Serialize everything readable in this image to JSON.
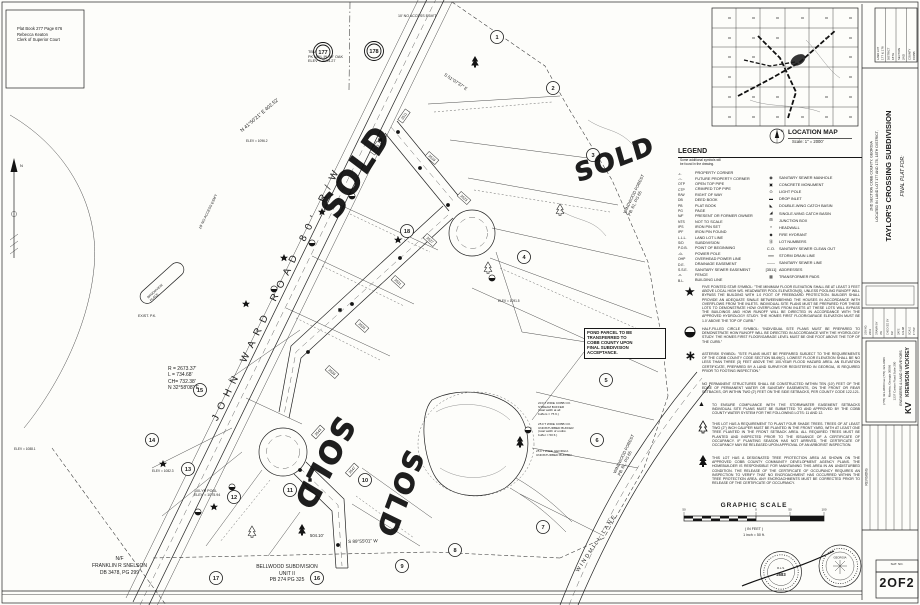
{
  "sheet": {
    "stamp": {
      "line1": "Plat Book 277 Page 676",
      "line2": "Rebecca Keaton",
      "line3": "Clerk of Superior Court"
    },
    "sheet_no": "2OF2",
    "sheet_no_strip": "SHT. NO."
  },
  "title_block": {
    "corner_table": {
      "labels": [
        "LAND LOT",
        "DISTRICT",
        "SECTION",
        "COUNTY"
      ],
      "values": [
        "177 & 178",
        "18TH",
        "2ND",
        "COBB"
      ]
    },
    "final_plat_for": "FINAL PLAT FOR:",
    "title": "TAYLOR'S CROSSING SUBDIVISION",
    "location_line1": "LOCATED IN LAND LOT 177 AND 178, 18TH DISTRICT,",
    "location_line2": "2ND SECTION COBB COUNTY, GEORGIA",
    "info": {
      "labels": [
        "JOB NO.",
        "DRAWN BY",
        "CHECKED BY",
        "DATE",
        "SCALE"
      ],
      "values": [
        "2411",
        "JW",
        "KV",
        "6-9-98",
        "1\"=50'"
      ]
    },
    "firm": {
      "logo": "KV",
      "name": "KREWSON  VICKREY",
      "type": "ENGINEERS & LAND SURVEYORS",
      "addr1": "1237 Canton Road  Suite 200",
      "addr2": "Marietta, Georgia 30066",
      "phone": "(770) 421-9600   Fax (770) 421-9606"
    },
    "revisions_label": "REVISIONS",
    "seal1_text": "R.L.S.",
    "seal1_no": "2683",
    "seal2_text": "GEORGIA"
  },
  "location_map": {
    "title": "LOCATION MAP",
    "scale": "Scale: 1\" = 2000'",
    "north": "N"
  },
  "legend": {
    "title": "LEGEND",
    "note1": "Some additional symbols will",
    "note2": "be found in the drawing.",
    "left": [
      {
        "abbr": "-•-",
        "label": "PROPERTY CORNER"
      },
      {
        "abbr": "-○-",
        "label": "FUTURE PROPERTY CORNER"
      },
      {
        "abbr": "OTP",
        "label": "OPEN TOP PIPE"
      },
      {
        "abbr": "CTP",
        "label": "CRIMPED TOP PIPE"
      },
      {
        "abbr": "R/W",
        "label": "RIGHT OF WAY"
      },
      {
        "abbr": "DB",
        "label": "DEED BOOK"
      },
      {
        "abbr": "PB",
        "label": "PLAT BOOK"
      },
      {
        "abbr": "PG",
        "label": "PAGE"
      },
      {
        "abbr": "N/F",
        "label": "PRESENT OR FORMER OWNER"
      },
      {
        "abbr": "NTS",
        "label": "NOT TO SCALE"
      },
      {
        "abbr": "IPS",
        "label": "IRON PIN SET"
      },
      {
        "abbr": "IPF",
        "label": "IRON PIN FOUND"
      },
      {
        "abbr": "L.L.L.",
        "label": "LAND LOT LINE"
      },
      {
        "abbr": "S/D",
        "label": "SUBDIVISION"
      },
      {
        "abbr": "P.O.B.",
        "label": "POINT OF BEGINNING"
      },
      {
        "abbr": "-⊙-",
        "label": "POWER POLE"
      },
      {
        "abbr": "OHP",
        "label": "OVERHEAD POWER LINE"
      },
      {
        "abbr": "D.E.",
        "label": "DRAINAGE EASEMENT"
      },
      {
        "abbr": "S.S.E.",
        "label": "SANITARY SEWER EASEMENT"
      },
      {
        "abbr": "-x-",
        "label": "FENCE"
      },
      {
        "abbr": "B.L.",
        "label": "BUILDING LINE"
      }
    ],
    "right": [
      {
        "sym": "◉",
        "label": "SANITARY SEWER MANHOLE"
      },
      {
        "sym": "▣",
        "label": "CONCRETE MONUMENT"
      },
      {
        "sym": "⊙",
        "label": "LIGHT POLE"
      },
      {
        "sym": "▬",
        "label": "DROP INLET"
      },
      {
        "sym": "◣",
        "label": "DOUBLE-WING CATCH BASIN"
      },
      {
        "sym": "◢",
        "label": "SINGLE-WING CATCH BASIN"
      },
      {
        "sym": "⊞",
        "label": "JUNCTION BOX"
      },
      {
        "sym": "∩",
        "label": "HEADWALL"
      },
      {
        "sym": "◆",
        "label": "FIRE HYDRANT"
      },
      {
        "sym": "⑮",
        "label": "LOT NUMBERS"
      },
      {
        "sym": "C.O.",
        "label": "SANITARY SEWER CLEAN OUT"
      },
      {
        "sym": "══",
        "label": "STORM DRAIN LINE"
      },
      {
        "sym": "——",
        "label": "SANITARY SEWER LINE"
      },
      {
        "sym": "[3511]",
        "label": "ADDRESSES"
      },
      {
        "sym": "▦",
        "label": "TRANSFORMER PADS"
      }
    ]
  },
  "notes": [
    {
      "icon": "five-pointed-star-icon",
      "glyph": "★",
      "text": "FIVE POINTED STAR SYMBOL: \"THE MINIMUM FLOOR ELEVATION SHALL BE AT LEAST 3 FEET ABOVE LOCAL HIGH WS. HEADWATER POOL ELEVATION(S), UNLESS POOLING RUNOFF WILL BYPASS THE BUILDING WITH 1.0 FOOT OF FREEBOARD PROTECTION. BUILDER SHALL PROVIDE AN ADEQUATE SWALE BETWEEN/BEHIND THE HOUSES IN ACCORDANCE WITH OVERFLOWS FROM THE INLETS. INDIVIDUAL SITE PLANS MUST BE PREPARED FOR THESE LOTS TO DEMONSTRATE HOW OVERFLOWS FROM INLETS AT THESE LOTS WILL BYPASS THE BUILDINGS AND HOW RUNOFF WILL BE DIRECTED IN ACCORDANCE WITH THE APPROVED HYDROLOGY STUDY. THE HOMES FIRST FLOOR/GARAGE ELEVATION MUST BE 1.0' ABOVE THE TOP OF CURB.\""
    },
    {
      "icon": "half-filled-circle-icon",
      "glyph": "",
      "text": "HALF-FILLED CIRCLE SYMBOL: \"INDIVIDUAL SITE PLANS MUST BE PREPARED TO DEMONSTRATE HOW RUNOFF WILL BE DIRECTED IN ACCORDANCE WITH THE HYDROLOGY STUDY. THE HOMES FIRST FLOOR/GARAGE LEVEL MUST BE ONE FOOT ABOVE THE TOP OF THE CURB.\""
    },
    {
      "icon": "asterisk-icon",
      "glyph": "∗",
      "text": "ASTERISK SYMBOL: \"SITE PLANS MUST BE PREPARED SUBJECT TO THE REQUIREMENTS OF THE COBB COUNTY CODE SECTION 58-69(C). LOWEST FLOOR ELEVATION SHALL BE NO LESS THAN THREE (3) FEET ABOVE THE 100-YEAR FLOOD HAZARD AREA. AN ELEVATION CERTIFICATE, PREPARED BY A LAND SURVEYOR REGISTERED IN GEORGIA, IS REQUIRED PRIOR TO FOOTING INSPECTION.\""
    },
    {
      "icon": "",
      "glyph": "",
      "text": "NO PERMANENT STRUCTURES SHALL BE CONSTRUCTED WITHIN TEN (10') FEET OF THE EDGE OF PERMANENT WATER OR SANITARY EASEMENTS, ON THE FRONT OR REAR SETBACKS, OR WITHIN TWO (2') FEET ON THE SIDE SETBACKS, PER COUNTY CODE 122-121."
    },
    {
      "icon": "triangle-icon",
      "glyph": "▲",
      "text": "TO ENSURE COMPLIANCE WITH THE STORMWATER EASEMENT SETBACKS INDIVIDUAL SITE PLANS MUST BE SUBMITTED TO AND APPROVED BY THE COBB COUNTY WATER SYSTEM FOR THE FOLLOWING LOTS: 11 AND 12."
    },
    {
      "icon": "open-tree-icon",
      "glyph": "",
      "text": "THIS LOT HAS A REQUIREMENT TO PLANT FOUR SHADE TREES. TREES OF AT LEAST TWO (2\") INCH CALIPER MUST BE PLANTED IN THE FRONT YARD, WITH AT LEAST ONE TREE PLANTED IN THE FRONT SETBACK AREA. ALL REQUIRED TREES MUST BE PLANTED AND INSPECTED PRIOR TO THE ISSUANCE OF A CERTIFICATE OF OCCUPANCY. IF PLANTING SEASON HAS NOT ARRIVED, THE CERTIFICATE OF OCCUPANCY MAY BE RELEASED UPON APPROVAL OF AN ARBORIST INSPECTION."
    },
    {
      "icon": "solid-tree-ic}on",
      "glyph": "",
      "text": "THIS LOT HAS A DESIGNATED TREE PROTECTION AREA AS SHOWN ON THE APPROVED COBB COUNTY COMMUNITY DEVELOPMENT AGENCY PLANS. THE HOMEBUILDER IS RESPONSIBLE FOR MAINTAINING THIS AREA IN AN UNDISTURBED CONDITION. THE RELEASE OF THE CERTIFICATE OF OCCUPANCY REQUIRES AN INSPECTION TO VERIFY THAT NO ENCROACHMENT HAS OCCURRED WITHIN THE TREE PROTECTION AREA. ANY ENCROACHMENTS MUST BE CORRECTED PRIOR TO RELEASE OF THE CERTIFICATE OF OCCUPANCY."
    }
  ],
  "graphic_scale": {
    "title": "GRAPHIC SCALE",
    "in_feet": "( IN FEET )",
    "ratio": "1 inch = 50 ft.",
    "ticks": [
      "50",
      "0",
      "50",
      "100"
    ]
  },
  "map": {
    "sold": "SOLD",
    "john_ward_road": "JOHN WARD ROAD 80' R/W",
    "brookview1": "BROOKVIEW",
    "brookview2": "PLACE",
    "curve": [
      "R = 2673.37'",
      "L  =  734.68'",
      "CH=  732.38'",
      "N 32°58'08\" E"
    ],
    "tbm": [
      "TBM",
      "PK NAIL IN 30\" OAK",
      "ELEV = 1104.27"
    ],
    "no_access1": "10' NO ACCESS ESM'T",
    "no_access2": "10' NO ACCESS ESM'T",
    "exist_pk": "EXIST. P.K.",
    "bearing_top": "N 41°50'21\" E   402.52'",
    "bearing_tr": "S 51°07'37\" E",
    "bearing_bottom": "S 89°55'01\" W",
    "dist_bottom": "504.10'",
    "snelson": [
      "N/F",
      "FRANKLIN R SNELSON",
      "DB 3478, PG 299"
    ],
    "bellwood": [
      "BELLWOOD SUBDIVISION",
      "UNIT II",
      "PB 274 PG 325"
    ],
    "windwood": [
      "WINDWOOD FOREST",
      "PB. 61, PG 65"
    ],
    "windmill_lane": "WINDMILL LANE",
    "pond_note": [
      "POND PARCEL TO BE",
      "TRANSFERRED TO",
      "COBB COUNTY UPON",
      "FINAL SUBDIVISION",
      "ACCEPTANCE."
    ],
    "pool_elev": [
      "100-YR POOL",
      "ELEV = 1075.94"
    ],
    "buffer1": [
      "20 FT WIDE COBB CO.",
      "STREAM BUFFER",
      "(total width at all",
      "buffers = 75 ft.)"
    ],
    "buffer2": [
      "25 FT WIDE COBB CO.",
      "UNDISTURBED BUFFER",
      "(total width of undist.",
      "buffer = 50 ft.)"
    ],
    "buffer3": [
      "25 FT WIDE GEORGIA",
      "UNDISTURBED BUFFER"
    ],
    "spot_elevs": [
      "ELEV = 1096.2",
      "ELEV = 1091.5",
      "ELEV = 1082.3",
      "ELEV = 1088.1"
    ],
    "north_label": "N",
    "land_lots": [
      "177",
      "178"
    ],
    "lots": [
      "1",
      "2",
      "3",
      "4",
      "5",
      "6",
      "7",
      "8",
      "9",
      "10",
      "11",
      "12",
      "13",
      "14",
      "15",
      "16",
      "17",
      "18"
    ],
    "addresses": [
      "3511",
      "3515",
      "3519",
      "3523",
      "3527",
      "3531",
      "3535",
      "3539",
      "3543",
      "3547"
    ]
  }
}
